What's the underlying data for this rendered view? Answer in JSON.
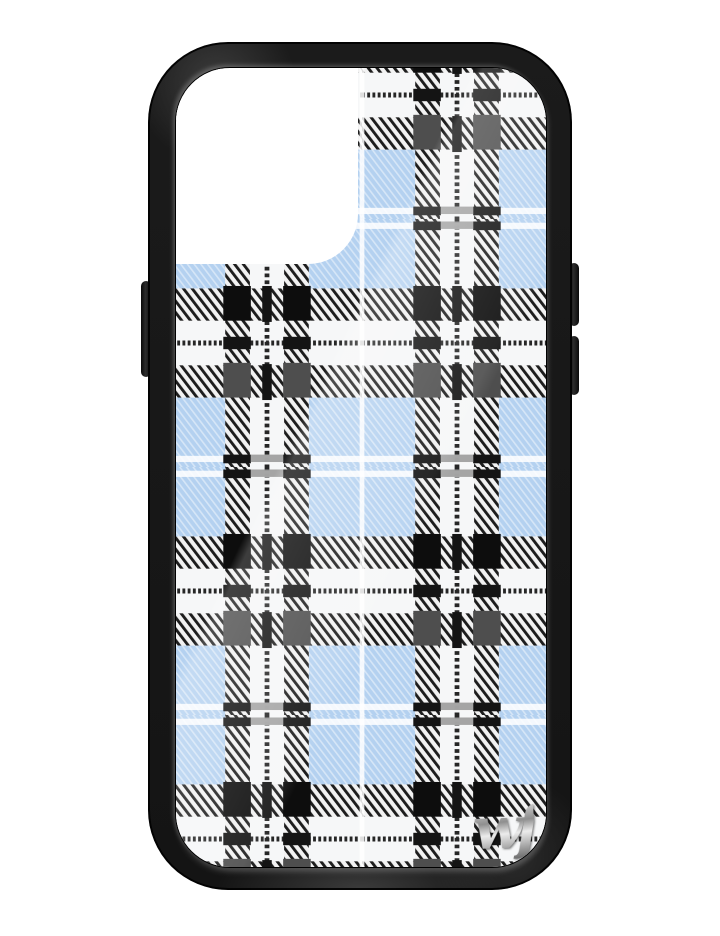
{
  "product": {
    "name": "Blue plaid phone case",
    "description": "Black bumper phone case with a light blue, white and black tartan plaid back, camera cutout and chrome script brand logo",
    "brand_logo_text": "wf"
  },
  "colors": {
    "page_background": "#ffffff",
    "frame_black": "#181818",
    "plaid_blue": "#b4d1f0",
    "plaid_white": "#f6f7f8",
    "hatch_base_white": "#f2f2f2",
    "hatch_stripe_dark": "#1d1d1d",
    "square_black": "#0d0d0d",
    "square_gray": "#4e4e4e",
    "center_line_dark": "#262626",
    "pinstripe_white": "#ffffff",
    "crossing_mark_black": "#141414",
    "crossing_mark_gray": "#9b9b9b",
    "logo_silver": "#c9c9c9"
  }
}
